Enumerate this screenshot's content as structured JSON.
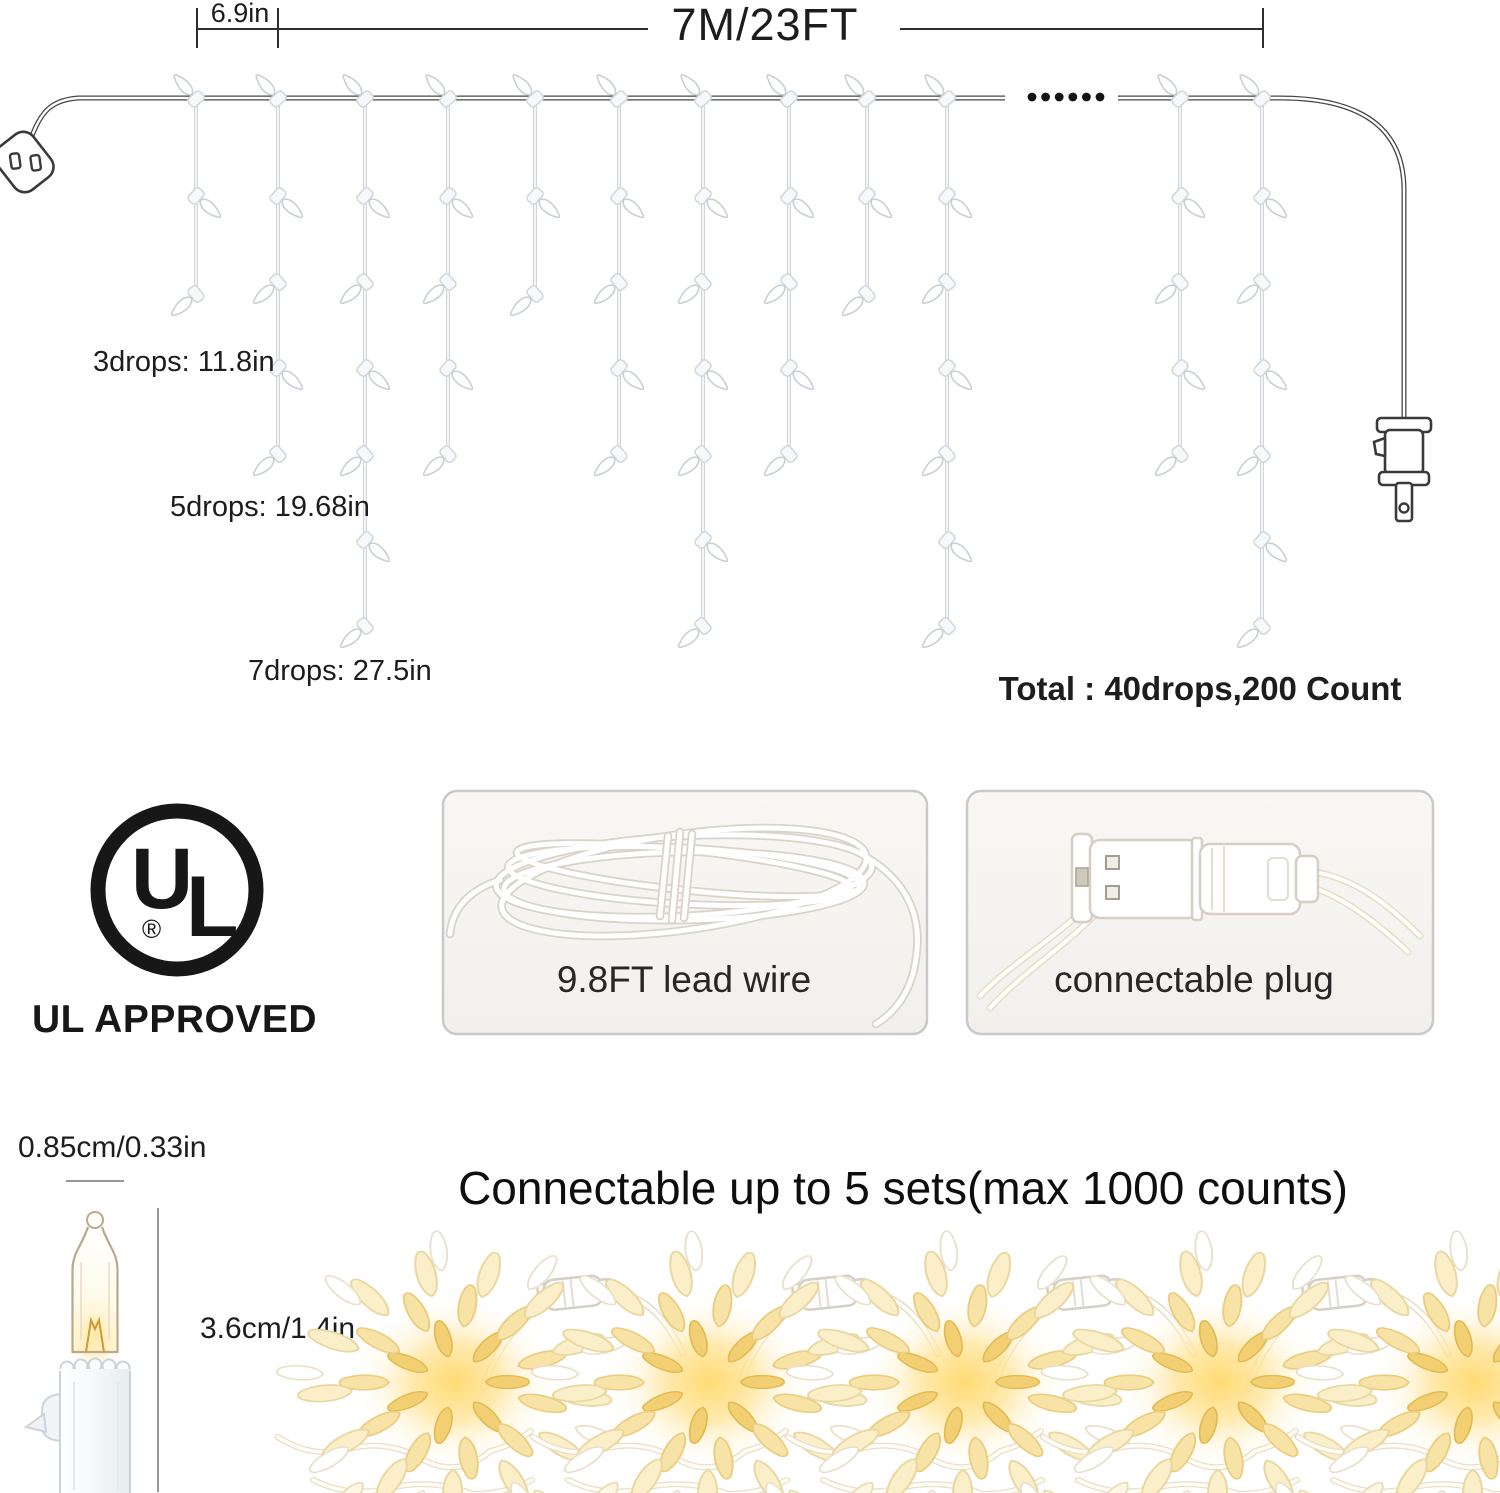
{
  "diagram": {
    "spacing_label": "6.9in",
    "total_length_label": "7M/23FT",
    "drop_length_labels": [
      "3drops: 11.8in",
      "5drops: 19.68in",
      "7drops: 27.5in"
    ],
    "total_label": "Total : 40drops,200 Count",
    "gap_dots_count": 6,
    "drops": [
      {
        "x": 196,
        "count": 3
      },
      {
        "x": 278,
        "count": 5
      },
      {
        "x": 365,
        "count": 7
      },
      {
        "x": 448,
        "count": 5
      },
      {
        "x": 535,
        "count": 3
      },
      {
        "x": 619,
        "count": 5
      },
      {
        "x": 703,
        "count": 7
      },
      {
        "x": 789,
        "count": 5
      },
      {
        "x": 867,
        "count": 3
      },
      {
        "x": 947,
        "count": 7
      },
      {
        "x": 1180,
        "count": 5
      },
      {
        "x": 1262,
        "count": 7
      }
    ]
  },
  "certification": {
    "logo_letter_u": "U",
    "logo_letter_l": "L",
    "registered_symbol": "®",
    "caption": "UL APPROVED"
  },
  "feature_cards": [
    {
      "caption": "9.8FT lead wire"
    },
    {
      "caption": "connectable plug"
    }
  ],
  "bulb_detail": {
    "width_label": "0.85cm/0.33in",
    "height_label": "3.6cm/1.4in"
  },
  "connectable_section": {
    "heading": "Connectable up to 5 sets(max 1000 counts)",
    "bundles": [
      {
        "x": 455
      },
      {
        "x": 710
      },
      {
        "x": 965
      },
      {
        "x": 1220
      },
      {
        "x": 1475
      }
    ],
    "connector_xs": [
      580,
      835,
      1090,
      1345
    ]
  },
  "colors": {
    "wire": "#474747",
    "drop_wire": "#c6cbd0",
    "warm_glow": "#ffe49a",
    "text": "#1d1d1d"
  }
}
